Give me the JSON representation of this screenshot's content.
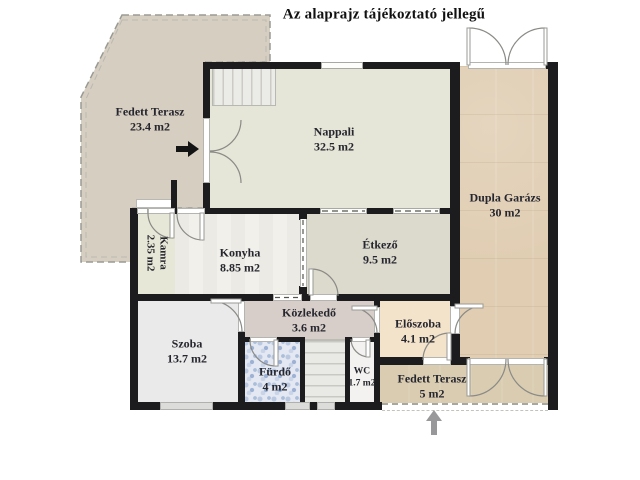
{
  "title": "Az alaprajz tájékoztató jellegű",
  "rooms": {
    "fedett_terasz": {
      "name": "Fedett Terasz",
      "area": "23.4 m2"
    },
    "nappali": {
      "name": "Nappali",
      "area": "32.5 m2"
    },
    "dupla_garazs": {
      "name": "Dupla Garázs",
      "area": "30 m2"
    },
    "kamra": {
      "name": "Kamra",
      "area": "2.35 m2"
    },
    "konyha": {
      "name": "Konyha",
      "area": "8.85 m2"
    },
    "etkezo": {
      "name": "Étkező",
      "area": "9.5 m2"
    },
    "kozlekedo": {
      "name": "Közlekedő",
      "area": "3.6 m2"
    },
    "szoba": {
      "name": "Szoba",
      "area": "13.7 m2"
    },
    "furdo": {
      "name": "Fürdő",
      "area": "4 m2"
    },
    "wc": {
      "name": "WC",
      "area": "1.7 m2"
    },
    "eloszoba": {
      "name": "Előszoba",
      "area": "4.1 m2"
    },
    "fedett_terasz_also": {
      "name": "Fedett Terasz",
      "area": "5 m2"
    }
  },
  "icons": {
    "main_entrance_arrow": "right-arrow",
    "terrace_entrance_arrow": "up-arrow"
  },
  "colors": {
    "wall": "#1c1c1e",
    "terrace_fill": "#d6cec1",
    "nappali_fill": "#e5e5d8",
    "garage_fill": "#e0cdb2",
    "etkezo_fill": "#dcd9cd",
    "kozlekedo_fill": "#d7cec9",
    "eloszoba_fill": "#f3e3ca",
    "furdo_tile": "#b9c8e0",
    "label_text": "#26262e"
  }
}
